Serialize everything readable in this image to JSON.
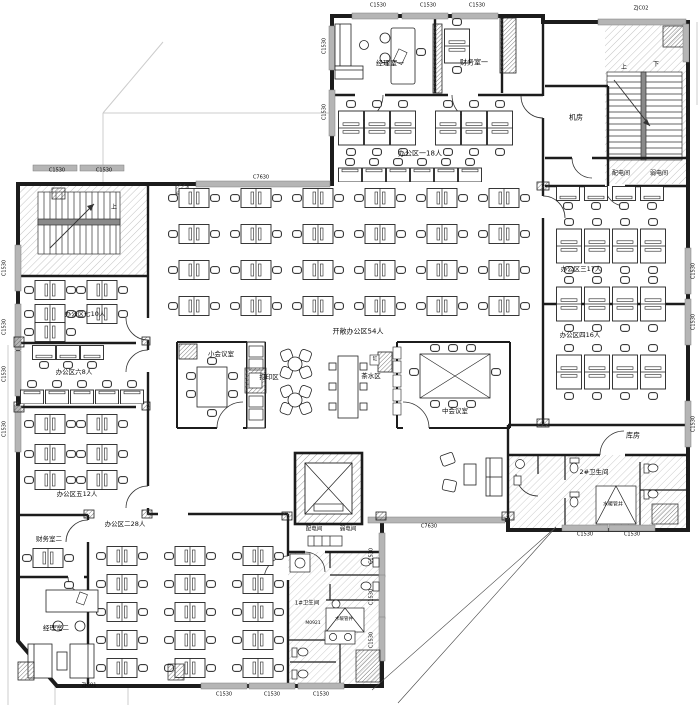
{
  "drawing": {
    "type": "office-floor-plan",
    "wall_color": "#1c1c1c",
    "window_color": "#b5b5b5"
  },
  "labels": [
    {
      "id": "window-c1530-top-1",
      "text": "C1530",
      "x": 378,
      "y": 6
    },
    {
      "id": "window-c1530-top-2",
      "text": "C1530",
      "x": 428,
      "y": 6
    },
    {
      "id": "window-c1530-top-3",
      "text": "C1530",
      "x": 477,
      "y": 6
    },
    {
      "id": "corner-window-zjc02",
      "text": "ZJC02",
      "x": 641,
      "y": 9
    },
    {
      "id": "window-c1530-wing-left-1",
      "text": "C1530",
      "x": 325,
      "y": 46,
      "rot": 1
    },
    {
      "id": "window-c1530-wing-left-2",
      "text": "C1530",
      "x": 325,
      "y": 112,
      "rot": 1
    },
    {
      "id": "room-manager-1",
      "text": "经理室一",
      "x": 390,
      "y": 64,
      "fs": 7
    },
    {
      "id": "room-finance-1",
      "text": "财务室一",
      "x": 474,
      "y": 63,
      "fs": 7
    },
    {
      "id": "area-1-18p",
      "text": "办公区一18人",
      "x": 420,
      "y": 154,
      "fs": 7
    },
    {
      "id": "room-machine",
      "text": "机房",
      "x": 576,
      "y": 118,
      "fs": 7
    },
    {
      "id": "room-power-top",
      "text": "配电间",
      "x": 621,
      "y": 174,
      "fs": 6
    },
    {
      "id": "room-weak-top",
      "text": "弱电间",
      "x": 659,
      "y": 174,
      "fs": 6
    },
    {
      "id": "stair-up-right",
      "text": "上",
      "x": 624,
      "y": 68,
      "fs": 6
    },
    {
      "id": "stair-down-right",
      "text": "下",
      "x": 656,
      "y": 65,
      "fs": 6
    },
    {
      "id": "window-c1530-topleft-1",
      "text": "C1530",
      "x": 57,
      "y": 171
    },
    {
      "id": "window-c1530-topleft-2",
      "text": "C1530",
      "x": 104,
      "y": 171
    },
    {
      "id": "stair-up-left",
      "text": "上",
      "x": 114,
      "y": 208,
      "fs": 6
    },
    {
      "id": "window-c7630-top",
      "text": "C7630",
      "x": 261,
      "y": 178
    },
    {
      "id": "area-7-10p",
      "text": "办公区七10人",
      "x": 85,
      "y": 314,
      "fs": 6.5
    },
    {
      "id": "area-6-8p",
      "text": "办公区六8人",
      "x": 74,
      "y": 372,
      "fs": 6.5
    },
    {
      "id": "area-5-12p",
      "text": "办公区五12人",
      "x": 77,
      "y": 494,
      "fs": 6.5
    },
    {
      "id": "window-c1530-left-1",
      "text": "C1530",
      "x": 5,
      "y": 268,
      "rot": 1
    },
    {
      "id": "window-c1530-left-2",
      "text": "C1530",
      "x": 5,
      "y": 327,
      "rot": 1
    },
    {
      "id": "window-c1530-left-3",
      "text": "C1530",
      "x": 5,
      "y": 374,
      "rot": 1
    },
    {
      "id": "window-c1530-left-4",
      "text": "C1530",
      "x": 5,
      "y": 429,
      "rot": 1
    },
    {
      "id": "area-open-54p",
      "text": "开敞办公区54人",
      "x": 358,
      "y": 332,
      "fs": 7
    },
    {
      "id": "room-meeting-small",
      "text": "小会议室",
      "x": 221,
      "y": 354,
      "fs": 6.5
    },
    {
      "id": "zone-print",
      "text": "打印区",
      "x": 269,
      "y": 377,
      "fs": 6.5
    },
    {
      "id": "zone-tea",
      "text": "茶水区",
      "x": 371,
      "y": 376,
      "fs": 6.5
    },
    {
      "id": "tea-appliance",
      "text": "缸",
      "x": 375,
      "y": 360,
      "fs": 4.5
    },
    {
      "id": "room-meeting-mid",
      "text": "中会议室",
      "x": 455,
      "y": 411,
      "fs": 6.5
    },
    {
      "id": "area-3-17p",
      "text": "办公区三17人",
      "x": 581,
      "y": 269,
      "fs": 6.5
    },
    {
      "id": "area-4-16p",
      "text": "办公区四16人",
      "x": 580,
      "y": 335,
      "fs": 6.5
    },
    {
      "id": "window-c1530-right-1",
      "text": "C1530",
      "x": 694,
      "y": 271,
      "rot": 1
    },
    {
      "id": "window-c1530-right-2",
      "text": "C1530",
      "x": 694,
      "y": 322,
      "rot": 1
    },
    {
      "id": "window-c1530-right-3",
      "text": "C1530",
      "x": 694,
      "y": 424,
      "rot": 1
    },
    {
      "id": "room-storage",
      "text": "库房",
      "x": 633,
      "y": 436,
      "fs": 7
    },
    {
      "id": "room-toilet-2",
      "text": "2#卫生间",
      "x": 594,
      "y": 472,
      "fs": 6.5
    },
    {
      "id": "shaft-pipe-2",
      "text": "水暖管井",
      "x": 613,
      "y": 505,
      "fs": 5
    },
    {
      "id": "window-c1530-t2b-1",
      "text": "C1530",
      "x": 585,
      "y": 535
    },
    {
      "id": "window-c1530-t2b-2",
      "text": "C1530",
      "x": 632,
      "y": 535
    },
    {
      "id": "area-2-28p",
      "text": "办公区二28人",
      "x": 125,
      "y": 524,
      "fs": 6.5
    },
    {
      "id": "room-finance-2",
      "text": "财务室二",
      "x": 49,
      "y": 539,
      "fs": 6.5
    },
    {
      "id": "room-manager-2",
      "text": "经理室二",
      "x": 56,
      "y": 628,
      "fs": 6.5
    },
    {
      "id": "corner-window-zjc01",
      "text": "ZJC01",
      "x": 89,
      "y": 686
    },
    {
      "id": "room-power-bottom",
      "text": "配电间",
      "x": 314,
      "y": 530,
      "fs": 5.5
    },
    {
      "id": "room-weak-bottom",
      "text": "弱电间",
      "x": 348,
      "y": 530,
      "fs": 5.5
    },
    {
      "id": "room-toilet-1",
      "text": "1#卫生间",
      "x": 307,
      "y": 604,
      "fs": 5.5
    },
    {
      "id": "door-m0921",
      "text": "M0921",
      "x": 313,
      "y": 624,
      "fs": 4.5
    },
    {
      "id": "shaft-pipe-1",
      "text": "水暖管井",
      "x": 344,
      "y": 620,
      "fs": 4.5
    },
    {
      "id": "window-c1530-mid-1",
      "text": "C1530",
      "x": 372,
      "y": 556,
      "rot": 1
    },
    {
      "id": "window-c1530-mid-2",
      "text": "C1530",
      "x": 372,
      "y": 597,
      "rot": 1
    },
    {
      "id": "window-c1530-mid-3",
      "text": "C1530",
      "x": 372,
      "y": 640,
      "rot": 1
    },
    {
      "id": "window-c1530-bottom-1",
      "text": "C1530",
      "x": 224,
      "y": 695
    },
    {
      "id": "window-c1530-bottom-2",
      "text": "C1530",
      "x": 272,
      "y": 695
    },
    {
      "id": "window-c1530-bottom-3",
      "text": "C1530",
      "x": 321,
      "y": 695
    },
    {
      "id": "window-c7630-bottom",
      "text": "C7630",
      "x": 429,
      "y": 527
    }
  ]
}
